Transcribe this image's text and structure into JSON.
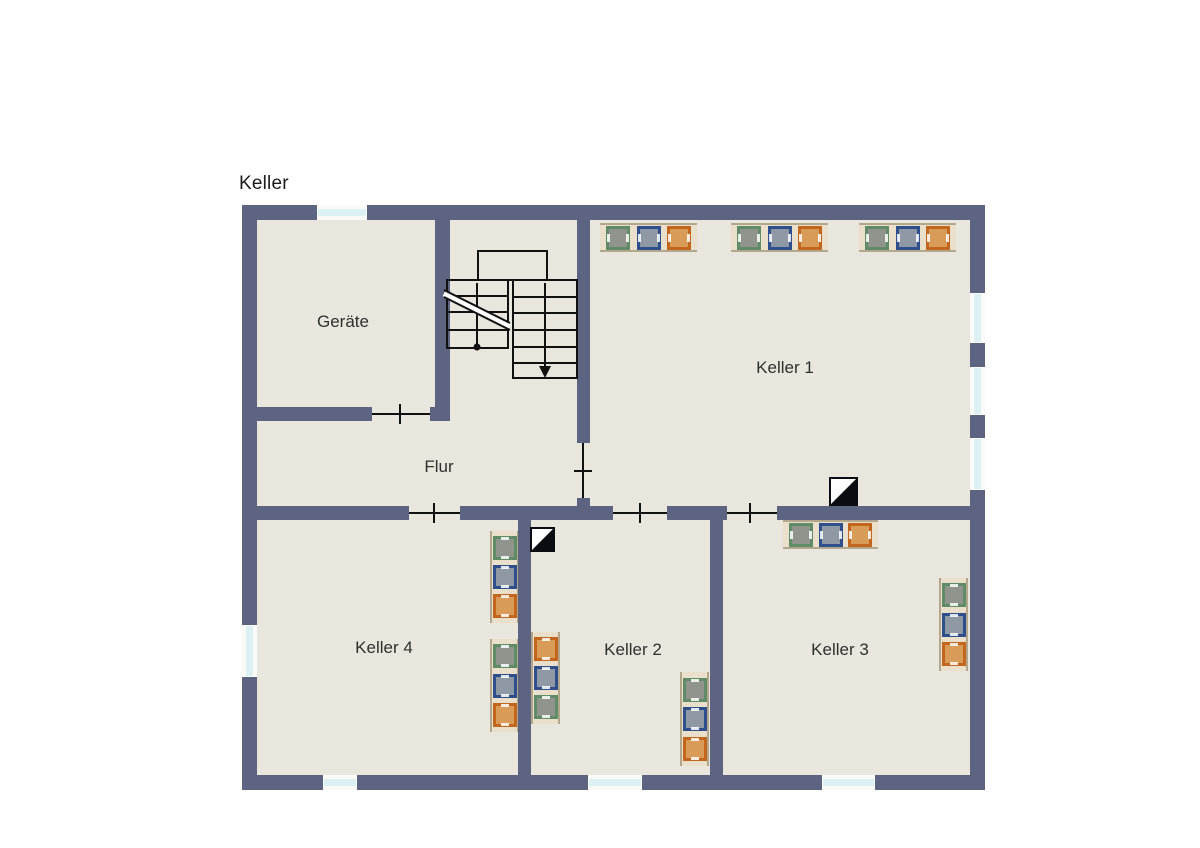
{
  "title": "Keller",
  "plan": {
    "bounds": {
      "x": 242,
      "y": 205,
      "w": 743,
      "h": 585
    },
    "colors": {
      "wall": "#5d6482",
      "floor": "#e9e6dd",
      "line": "#111111",
      "window_pane": "#dcf1f4",
      "window_frame": "#fafaf8",
      "shelf_bg": "#eadfca",
      "shelf_edge": "#b2a68c",
      "label": "#2f2f2f",
      "title": "#1c1c1c",
      "chimney_black": "#0b0b12",
      "chimney_white": "#ffffff",
      "machine_palette": {
        "green": {
          "border": "#5f8c66",
          "fill": "#90948c"
        },
        "blue": {
          "border": "#2f4f8c",
          "fill": "#8f99a6"
        },
        "orange": {
          "border": "#c2661d",
          "fill": "#d99c58"
        }
      }
    },
    "title_pos": {
      "x": 239,
      "y": 173
    },
    "rooms": [
      {
        "id": "geraete",
        "label": "Geräte",
        "cx": 343,
        "cy": 322
      },
      {
        "id": "flur",
        "label": "Flur",
        "cx": 439,
        "cy": 467
      },
      {
        "id": "keller-1",
        "label": "Keller 1",
        "cx": 785,
        "cy": 368
      },
      {
        "id": "keller-2",
        "label": "Keller 2",
        "cx": 633,
        "cy": 650
      },
      {
        "id": "keller-3",
        "label": "Keller 3",
        "cx": 840,
        "cy": 650
      },
      {
        "id": "keller-4",
        "label": "Keller 4",
        "cx": 384,
        "cy": 648
      }
    ],
    "walls": [
      [
        242,
        205,
        743,
        15
      ],
      [
        242,
        775,
        743,
        15
      ],
      [
        242,
        205,
        15,
        585
      ],
      [
        970,
        205,
        15,
        585
      ],
      [
        435,
        220,
        15,
        201
      ],
      [
        257,
        407,
        115,
        14
      ],
      [
        430,
        407,
        20,
        14
      ],
      [
        577,
        220,
        13,
        223
      ],
      [
        577,
        498,
        13,
        9
      ],
      [
        257,
        506,
        152,
        14
      ],
      [
        460,
        506,
        153,
        14
      ],
      [
        667,
        506,
        60,
        14
      ],
      [
        777,
        506,
        193,
        14
      ],
      [
        518,
        520,
        13,
        255
      ],
      [
        710,
        520,
        13,
        255
      ]
    ],
    "windows": [
      {
        "x": 317,
        "y": 205,
        "w": 50,
        "h": 15,
        "o": "h"
      },
      {
        "x": 323,
        "y": 775,
        "w": 34,
        "h": 15,
        "o": "h"
      },
      {
        "x": 588,
        "y": 775,
        "w": 54,
        "h": 15,
        "o": "h"
      },
      {
        "x": 822,
        "y": 775,
        "w": 53,
        "h": 15,
        "o": "h"
      },
      {
        "x": 242,
        "y": 625,
        "w": 15,
        "h": 52,
        "o": "v"
      },
      {
        "x": 970,
        "y": 293,
        "w": 15,
        "h": 50,
        "o": "v"
      },
      {
        "x": 970,
        "y": 367,
        "w": 15,
        "h": 48,
        "o": "v"
      },
      {
        "x": 970,
        "y": 438,
        "w": 15,
        "h": 52,
        "o": "v"
      }
    ],
    "doors": [
      {
        "line": [
          372,
          414,
          430,
          414
        ],
        "tick": [
          400,
          404,
          400,
          424
        ]
      },
      {
        "line": [
          583,
          443,
          583,
          498
        ],
        "tick": [
          574,
          471,
          592,
          471
        ]
      },
      {
        "line": [
          409,
          513,
          460,
          513
        ],
        "tick": [
          434,
          503,
          434,
          523
        ]
      },
      {
        "line": [
          613,
          513,
          667,
          513
        ],
        "tick": [
          640,
          503,
          640,
          523
        ]
      },
      {
        "line": [
          727,
          513,
          777,
          513
        ],
        "tick": [
          750,
          503,
          750,
          523
        ]
      }
    ],
    "stairs": {
      "rects": [
        [
          478,
          251,
          69,
          29
        ],
        [
          447,
          280,
          61,
          68
        ],
        [
          513,
          280,
          64,
          98
        ]
      ],
      "hlines": [
        [
          447,
          508,
          296
        ],
        [
          447,
          508,
          312
        ],
        [
          447,
          508,
          330
        ],
        [
          513,
          577,
          297
        ],
        [
          513,
          577,
          313
        ],
        [
          513,
          577,
          330
        ],
        [
          513,
          577,
          347
        ],
        [
          513,
          577,
          363
        ]
      ],
      "break_line": {
        "x1": 444,
        "y1a": 290,
        "x2": 510,
        "y2a": 323,
        "offset": 7
      },
      "dot": [
        477,
        347
      ],
      "walkline_up": [
        477,
        283,
        477,
        347
      ],
      "arrow": {
        "x": 545,
        "y1": 283,
        "y2": 369,
        "head": [
          [
            545,
            378
          ],
          [
            539,
            366
          ],
          [
            551,
            366
          ]
        ]
      }
    },
    "chimneys": [
      {
        "x": 829,
        "y": 477,
        "s": 29
      },
      {
        "x": 530,
        "y": 527,
        "s": 25
      }
    ],
    "appliance_groups": [
      {
        "x": 600,
        "y": 223,
        "w": 97,
        "h": 29,
        "o": "h",
        "colors": [
          "green",
          "blue",
          "orange"
        ]
      },
      {
        "x": 731,
        "y": 223,
        "w": 97,
        "h": 29,
        "o": "h",
        "colors": [
          "green",
          "blue",
          "orange"
        ]
      },
      {
        "x": 859,
        "y": 223,
        "w": 97,
        "h": 29,
        "o": "h",
        "colors": [
          "green",
          "blue",
          "orange"
        ]
      },
      {
        "x": 783,
        "y": 520,
        "w": 95,
        "h": 29,
        "o": "h",
        "colors": [
          "green",
          "blue",
          "orange"
        ]
      },
      {
        "x": 939,
        "y": 578,
        "w": 29,
        "h": 93,
        "o": "v",
        "colors": [
          "green",
          "blue",
          "orange"
        ]
      },
      {
        "x": 490,
        "y": 531,
        "w": 29,
        "h": 92,
        "o": "v",
        "colors": [
          "green",
          "blue",
          "orange"
        ]
      },
      {
        "x": 490,
        "y": 639,
        "w": 29,
        "h": 93,
        "o": "v",
        "colors": [
          "green",
          "blue",
          "orange"
        ]
      },
      {
        "x": 531,
        "y": 632,
        "w": 29,
        "h": 92,
        "o": "v",
        "colors": [
          "orange",
          "blue",
          "green"
        ]
      },
      {
        "x": 680,
        "y": 672,
        "w": 29,
        "h": 94,
        "o": "v",
        "colors": [
          "green",
          "blue",
          "orange"
        ]
      }
    ]
  }
}
